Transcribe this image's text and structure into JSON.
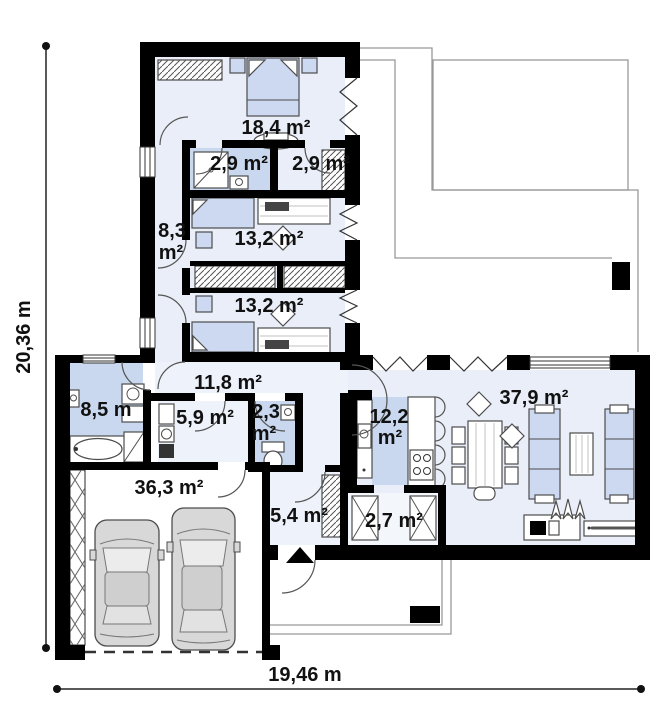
{
  "plan": {
    "type": "single-storey house floor plan",
    "dimensions": {
      "height_label": "20,36 m",
      "width_label": "19,46 m"
    },
    "rooms": [
      {
        "name": "bedroom-master",
        "label": "18,4 m²"
      },
      {
        "name": "shower-room",
        "label": "2,9 m²"
      },
      {
        "name": "wardrobe-room",
        "label": "2,9 m²"
      },
      {
        "name": "corridor",
        "label_line1": "8,3",
        "label_line2": "m²"
      },
      {
        "name": "bedroom-2",
        "label": "13,2 m²"
      },
      {
        "name": "bedroom-3",
        "label": "13,2 m²"
      },
      {
        "name": "hall",
        "label": "11,8 m²"
      },
      {
        "name": "bathroom",
        "label": "8,5 m"
      },
      {
        "name": "utility-room",
        "label": "5,9 m²"
      },
      {
        "name": "wc",
        "label_line1": "2,3",
        "label_line2": "m²"
      },
      {
        "name": "garage",
        "label": "36,3 m²"
      },
      {
        "name": "vestibule",
        "label": "5,4 m²"
      },
      {
        "name": "kitchen",
        "label_line1": "12,2",
        "label_line2": "m²"
      },
      {
        "name": "pantry",
        "label": "2,7 m²"
      },
      {
        "name": "living-room",
        "label": "37,9 m²"
      }
    ],
    "colors": {
      "wall": "#000000",
      "room_light": "#e9eef8",
      "room_pale": "#eef2fa",
      "room_blue": "#c9d8ee",
      "furniture_blue": "#cdd9f0",
      "car_body": "#d8d8d8"
    }
  }
}
